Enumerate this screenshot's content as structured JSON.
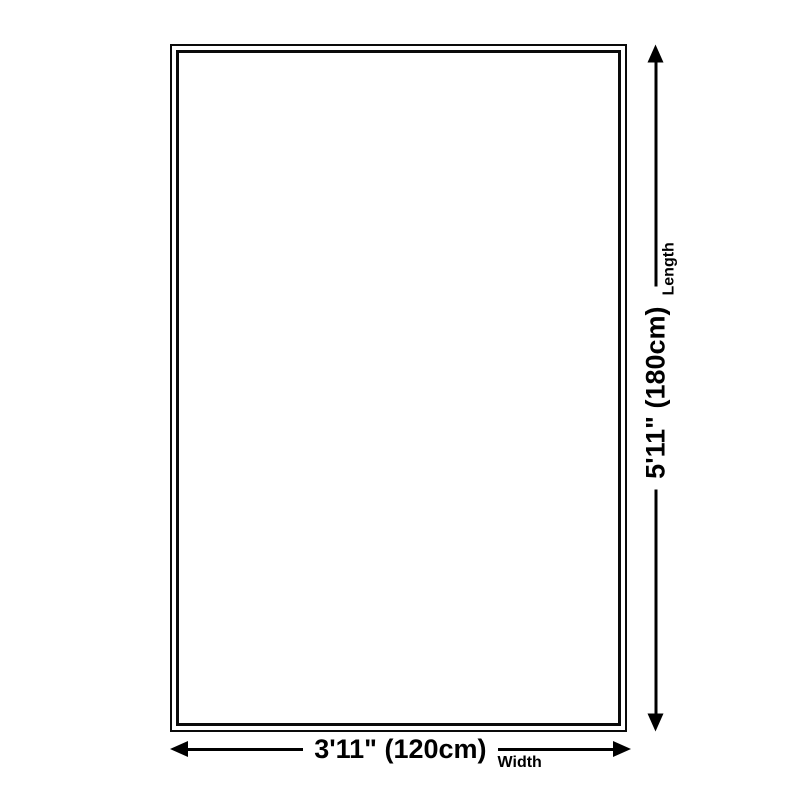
{
  "page": {
    "background": "#ffffff",
    "ink_color": "#000000"
  },
  "diagram": {
    "shape": "rectangle-outline",
    "width_dim": {
      "value": "3'11\" (120cm)",
      "label": "Width"
    },
    "length_dim": {
      "value": "5'11\" (180cm)",
      "label": "Length"
    }
  }
}
